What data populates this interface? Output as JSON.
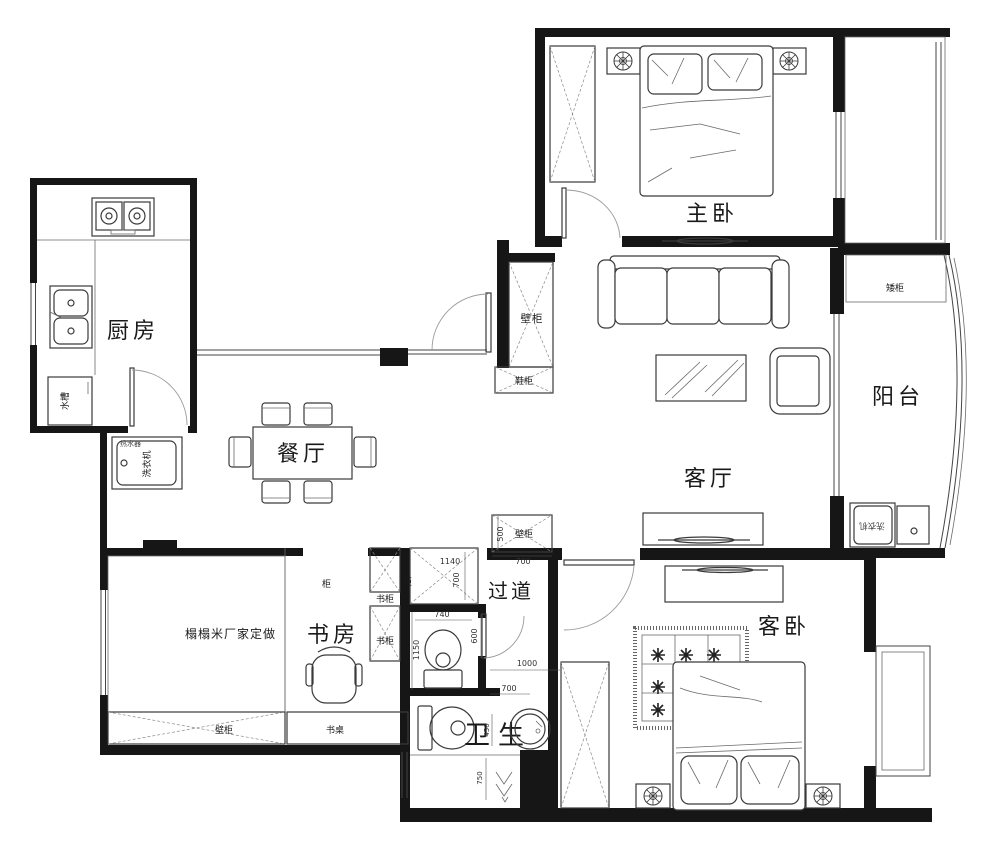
{
  "type": "apartment-floor-plan",
  "rooms": {
    "kitchen": "厨房",
    "dining": "餐厅",
    "living_room": "客厅",
    "master_bedroom": "主卧",
    "balcony": "阳台",
    "study": "书房",
    "hallway": "过道",
    "guest_bedroom": "客卧",
    "bathroom": "卫生"
  },
  "labels": {
    "sink": "水槽",
    "washing_machine": "洗衣机",
    "water_heater": "热水器",
    "entry_wall_cabinet": "壁柜",
    "shoe_cabinet": "鞋柜",
    "hall_wall_cabinet": "壁柜",
    "low_cabinet": "矮柜",
    "balcony_washing_machine": "洗衣机",
    "study_top_cabinet": "柜",
    "corridor_cabinet": "柜",
    "bookcase_1": "书柜",
    "bookcase_2": "书柜",
    "tatami_note": "榻榻米厂家定做",
    "study_wall_cabinet": "壁柜",
    "desk": "书桌"
  },
  "dimensions": {
    "hall_cabinet_depth": "500",
    "hall_cabinet_width": "700",
    "hall_width": "1140",
    "hall_length": "700",
    "corridor_cabinet_width": "740",
    "wc_door": "600",
    "wc_depth": "1150",
    "bath_width": "1000",
    "bath_door": "700",
    "basin_gap": "450",
    "shower_depth": "750"
  },
  "colors": {
    "wall": "#161616",
    "line": "#3a3a3a",
    "dim": "#333333",
    "paper": "#ffffff"
  }
}
